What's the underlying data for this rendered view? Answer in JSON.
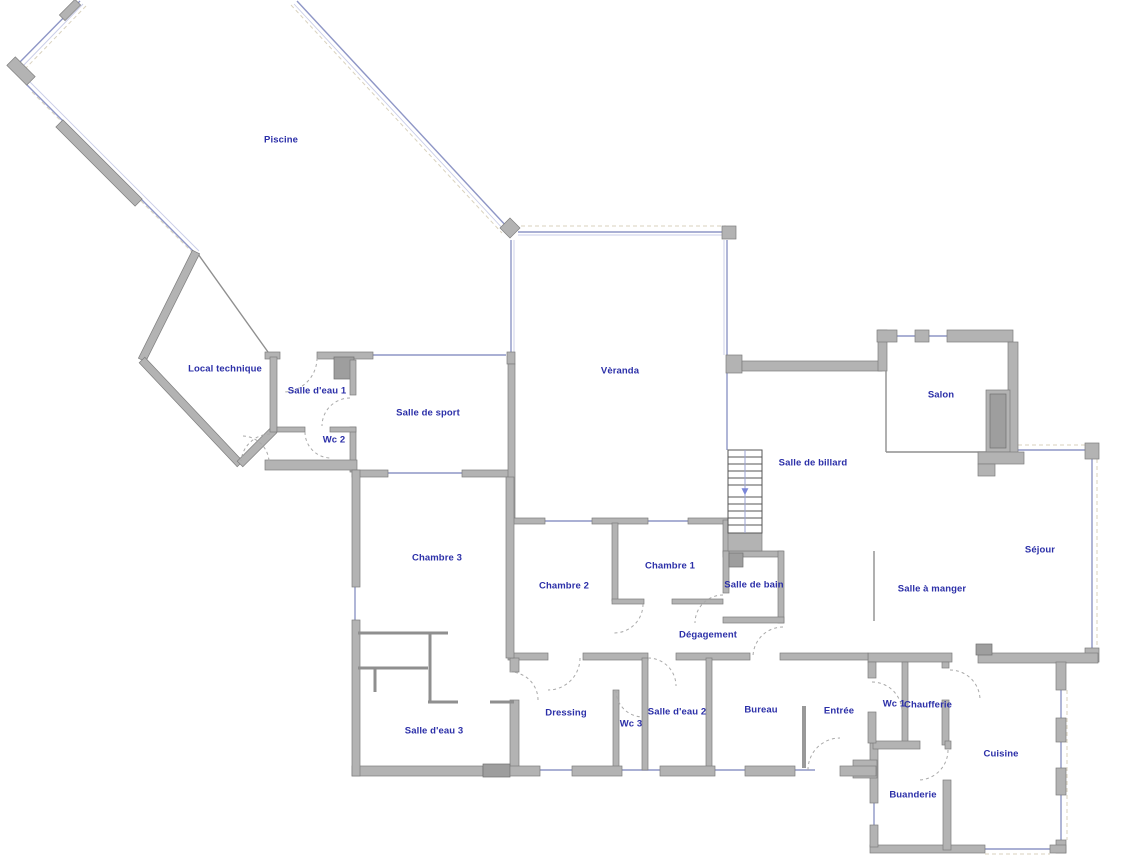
{
  "plan": {
    "rooms": [
      {
        "label": "Piscine"
      },
      {
        "label": "Local technique"
      },
      {
        "label": "Salle d'eau 1"
      },
      {
        "label": "Wc 2"
      },
      {
        "label": "Salle de sport"
      },
      {
        "label": "Vèranda"
      },
      {
        "label": "Salle de billard"
      },
      {
        "label": "Salon"
      },
      {
        "label": "Chambre 3"
      },
      {
        "label": "Chambre 2"
      },
      {
        "label": "Chambre 1"
      },
      {
        "label": "Salle de bain"
      },
      {
        "label": "Séjour"
      },
      {
        "label": "Salle à manger"
      },
      {
        "label": "Dégagement"
      },
      {
        "label": "Dressing"
      },
      {
        "label": "Wc 3"
      },
      {
        "label": "Salle d'eau 2"
      },
      {
        "label": "Bureau"
      },
      {
        "label": "Entrée"
      },
      {
        "label": "Wc 1"
      },
      {
        "label": "Chaufferie"
      },
      {
        "label": "Cuisine"
      },
      {
        "label": "Buanderie"
      },
      {
        "label": "Salle d'eau 3"
      }
    ],
    "stairs": {
      "direction_icon": "▼"
    },
    "colors": {
      "label": "#2b2fa8",
      "wall": "#b3b3b3",
      "glass": "#8e96c6"
    }
  }
}
